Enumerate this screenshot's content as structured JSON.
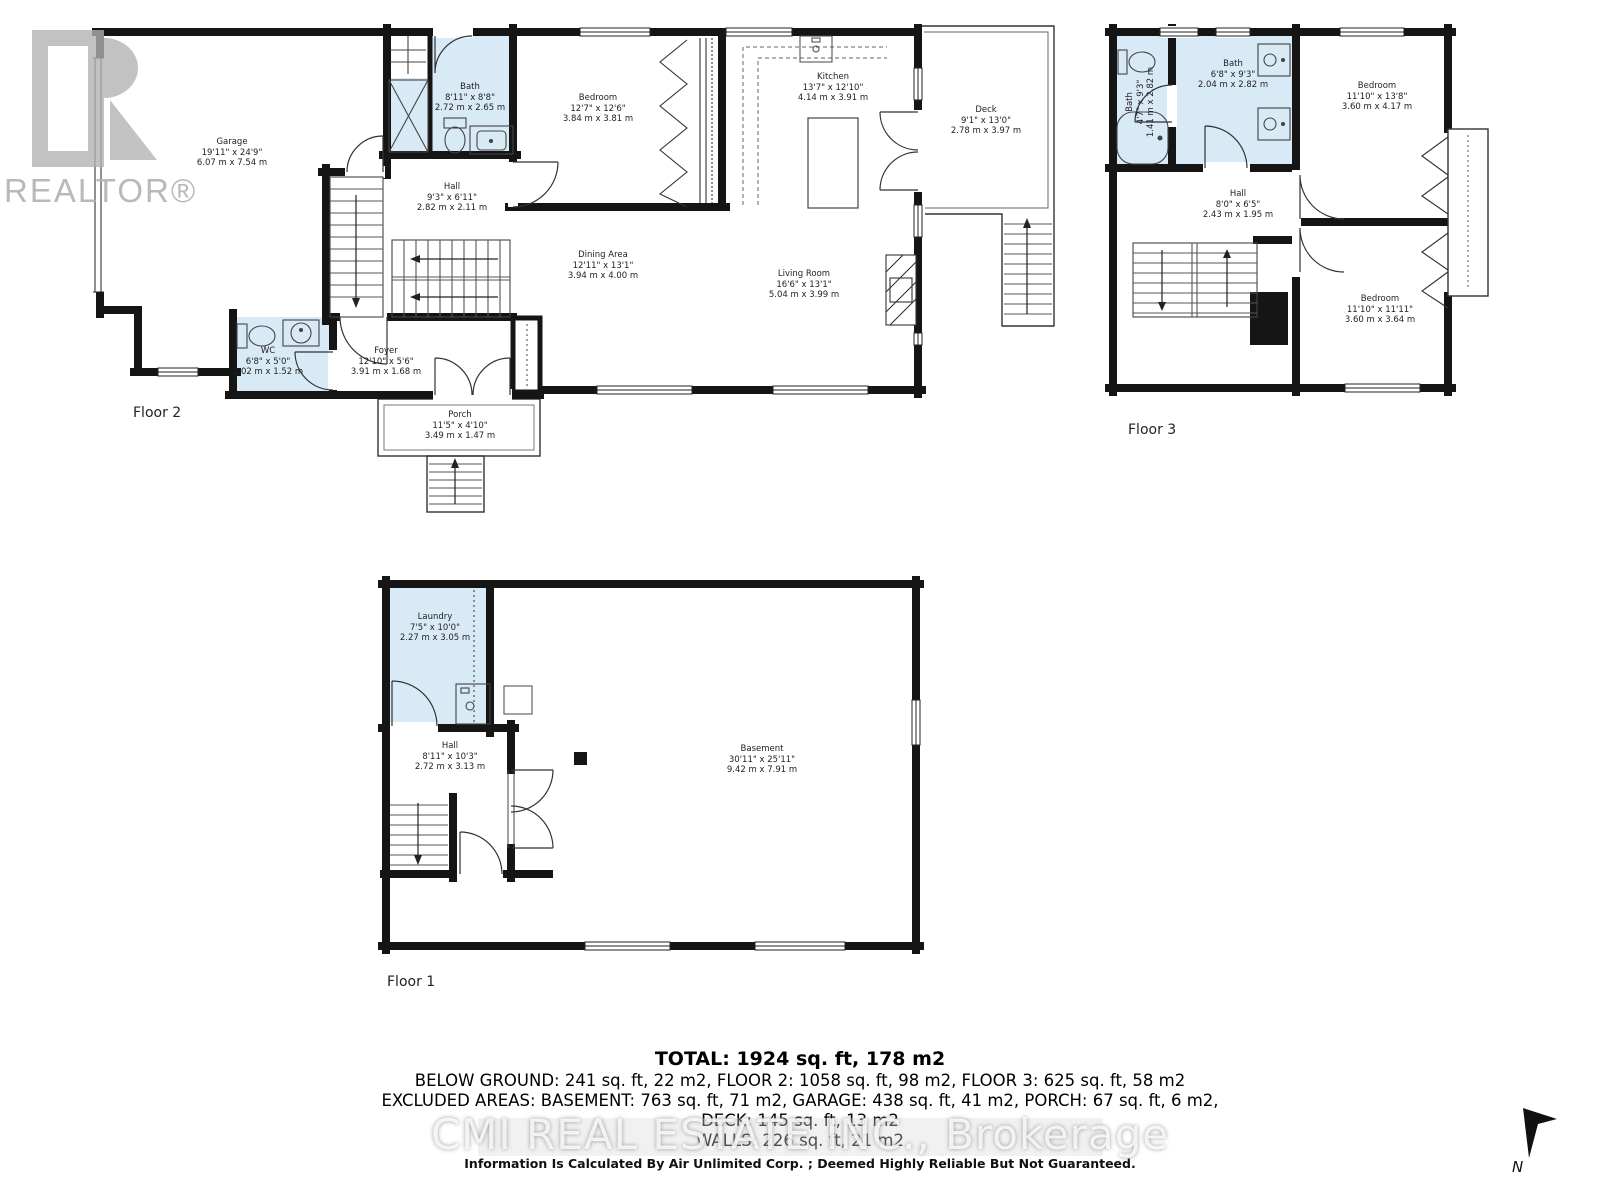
{
  "branding": {
    "logo_text": "REALTOR®",
    "center_watermark": "CMI REAL ESTATE INC., Brokerage"
  },
  "floors": [
    {
      "label": "Floor 2",
      "rooms": [
        {
          "name": "Garage",
          "ft": "19'11\" x 24'9\"",
          "m": "6.07 m x 7.54 m"
        },
        {
          "name": "Bath",
          "ft": "8'11\" x 8'8\"",
          "m": "2.72 m x 2.65 m"
        },
        {
          "name": "Bedroom",
          "ft": "12'7\" x 12'6\"",
          "m": "3.84 m x 3.81 m"
        },
        {
          "name": "Kitchen",
          "ft": "13'7\" x 12'10\"",
          "m": "4.14 m x 3.91 m"
        },
        {
          "name": "Deck",
          "ft": "9'1\" x 13'0\"",
          "m": "2.78 m x 3.97 m"
        },
        {
          "name": "Hall",
          "ft": "9'3\" x 6'11\"",
          "m": "2.82 m x 2.11 m"
        },
        {
          "name": "Dining Area",
          "ft": "12'11\" x 13'1\"",
          "m": "3.94 m x 4.00 m"
        },
        {
          "name": "Living Room",
          "ft": "16'6\" x 13'1\"",
          "m": "5.04 m x 3.99 m"
        },
        {
          "name": "WC",
          "ft": "6'8\" x 5'0\"",
          "m": "2.02 m x 1.52 m"
        },
        {
          "name": "Foyer",
          "ft": "12'10\" x 5'6\"",
          "m": "3.91 m x 1.68 m"
        },
        {
          "name": "Porch",
          "ft": "11'5\" x 4'10\"",
          "m": "3.49 m x 1.47 m"
        }
      ]
    },
    {
      "label": "Floor 3",
      "rooms": [
        {
          "name": "Bath",
          "ft": "4'7\" x 9'3\"",
          "m": "1.41 m x 2.82 m"
        },
        {
          "name": "Bath",
          "ft": "6'8\" x 9'3\"",
          "m": "2.04 m x 2.82 m"
        },
        {
          "name": "Bedroom",
          "ft": "11'10\" x 13'8\"",
          "m": "3.60 m x 4.17 m"
        },
        {
          "name": "Hall",
          "ft": "8'0\" x 6'5\"",
          "m": "2.43 m x 1.95 m"
        },
        {
          "name": "Bedroom",
          "ft": "11'10\" x 11'11\"",
          "m": "3.60 m x 3.64 m"
        }
      ]
    },
    {
      "label": "Floor 1",
      "rooms": [
        {
          "name": "Laundry",
          "ft": "7'5\" x 10'0\"",
          "m": "2.27 m x 3.05 m"
        },
        {
          "name": "Hall",
          "ft": "8'11\" x 10'3\"",
          "m": "2.72 m x 3.13 m"
        },
        {
          "name": "Basement",
          "ft": "30'11\" x 25'11\"",
          "m": "9.42 m x 7.91 m"
        }
      ]
    }
  ],
  "summary": {
    "total": "TOTAL: 1924 sq. ft, 178 m2",
    "line2": "BELOW GROUND: 241 sq. ft, 22 m2, FLOOR 2: 1058 sq. ft, 98 m2, FLOOR 3: 625 sq. ft, 58 m2",
    "line3": "EXCLUDED AREAS: BASEMENT: 763 sq. ft, 71 m2, GARAGE: 438 sq. ft, 41 m2, PORCH: 67 sq. ft, 6 m2,",
    "line4": "DECK: 145 sq. ft, 13 m2",
    "line5": "WALLS: 226 sq. ft, 21 m2"
  },
  "disclaimer": "Information Is Calculated By Air Unlimited Corp. ; Deemed Highly Reliable But Not Guaranteed.",
  "compass": {
    "label": "N"
  },
  "colors": {
    "wall": "#151515",
    "bath_fill": "#d9eaf7",
    "watermark_gray": "#b2b2b2"
  }
}
